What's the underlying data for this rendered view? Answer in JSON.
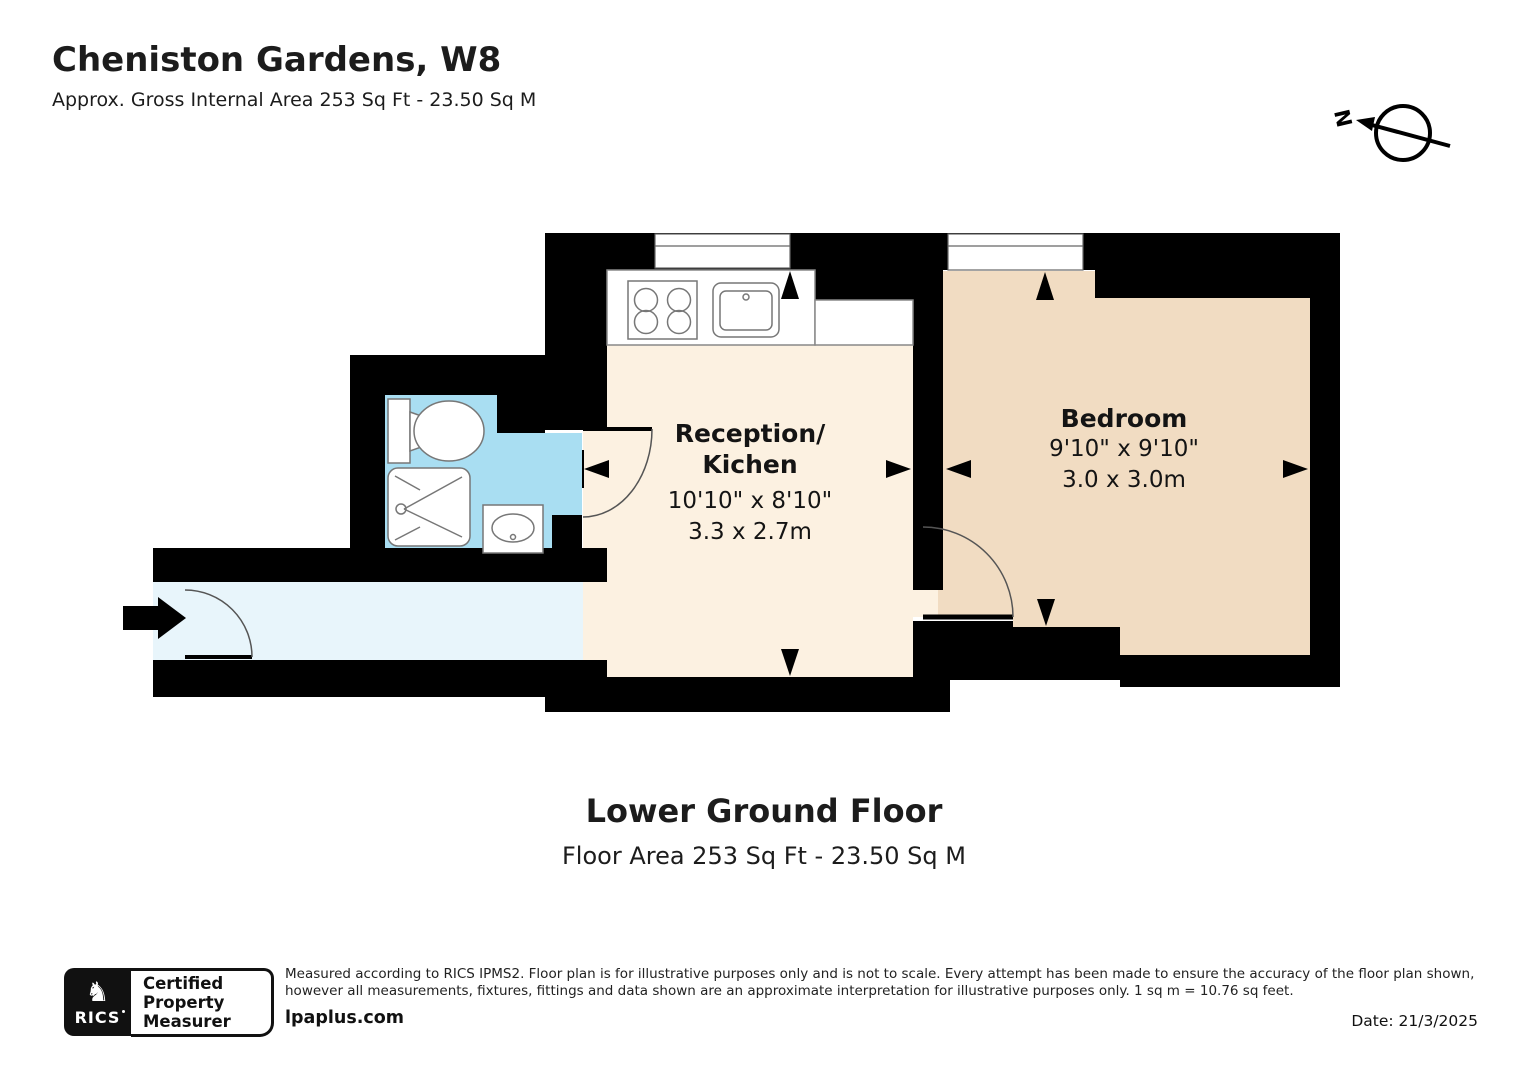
{
  "header": {
    "title": "Cheniston Gardens, W8",
    "subtitle": "Approx. Gross Internal Area 253 Sq Ft - 23.50 Sq M"
  },
  "compass": {
    "north_label": "N"
  },
  "rooms": {
    "reception": {
      "name_line1": "Reception/",
      "name_line2": "Kichen",
      "dims_imperial": "10'10\" x 8'10\"",
      "dims_metric": "3.3 x 2.7m"
    },
    "bedroom": {
      "name": "Bedroom",
      "dims_imperial": "9'10\" x 9'10\"",
      "dims_metric": "3.0 x 3.0m"
    }
  },
  "floor": {
    "title": "Lower Ground Floor",
    "area": "Floor Area 253 Sq Ft - 23.50 Sq M"
  },
  "footer": {
    "badge": {
      "emblem_glyph": "♞",
      "brand": "RICS",
      "label_line1": "Certified",
      "label_line2": "Property",
      "label_line3": "Measurer"
    },
    "disclaimer": "Measured according to RICS IPMS2. Floor plan is for illustrative purposes only and is not to scale. Every attempt has been made to ensure the accuracy of the floor plan shown, however all measurements, fixtures, fittings and data shown are an approximate interpretation for illustrative purposes only. 1 sq m = 10.76 sq feet.",
    "website": "lpaplus.com",
    "date": "Date: 21/3/2025"
  },
  "colors": {
    "wall": "#000000",
    "reception_floor": "#fcf1e1",
    "bedroom_floor": "#f1dcc2",
    "bathroom_floor": "#a9def2",
    "hallway_floor": "#e8f5fb",
    "fixture_stroke": "#777777"
  }
}
